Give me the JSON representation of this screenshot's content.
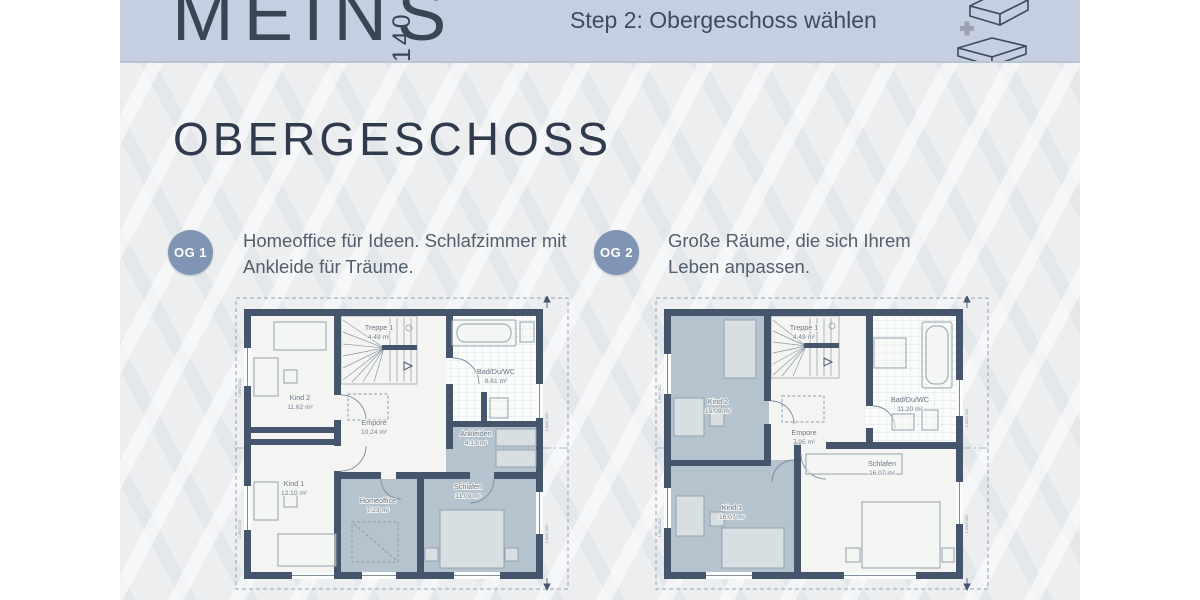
{
  "header": {
    "brand": "MEINS",
    "brand_number": "140",
    "step": "Step 2: Obergeschoss wählen",
    "icon": "add-upper-floor-icon"
  },
  "title": "OBERGESCHOSS",
  "colors": {
    "header_band": "#c5cfe1",
    "badge": "#8095b3",
    "wall": "#45566c",
    "room_shaded": "#b5c3ce",
    "heading_text": "#2f3b4c"
  },
  "options": [
    {
      "badge": "OG 1",
      "description": "Homeoffice für Ideen. Schlafzimmer mit Ankleide für Träume.",
      "rooms": {
        "treppe": {
          "name": "Treppe 1",
          "area": "4.49 m²"
        },
        "kind2": {
          "name": "Kind 2",
          "area": "11.62 m²"
        },
        "bad": {
          "name": "Bad/Du/WC",
          "area": "8.61 m²"
        },
        "empore": {
          "name": "Empore",
          "area": "10.24 m²"
        },
        "ankleiden": {
          "name": "Ankleiden",
          "area": "4.13 m²"
        },
        "kind1": {
          "name": "Kind 1",
          "area": "12.10 m²"
        },
        "homeoffice": {
          "name": "Homeoffice",
          "area": "7.23 m²"
        },
        "schlafen": {
          "name": "Schlafen",
          "area": "11.09 m²"
        }
      },
      "dims": {
        "left_upper": "1.99/2.192",
        "left_lower": "1.99/2.192",
        "right_upper": "1.00/2.092",
        "right_lower": "1.00/2.092"
      }
    },
    {
      "badge": "OG 2",
      "description": "Große Räume, die sich Ihrem Leben anpassen.",
      "rooms": {
        "treppe": {
          "name": "Treppe 1",
          "area": "4.49 m²"
        },
        "kind2": {
          "name": "Kind 2",
          "area": "15.09 m²"
        },
        "bad": {
          "name": "Bad/Du/WC",
          "area": "11.20 m²"
        },
        "empore": {
          "name": "Empore",
          "area": "7.95 m²"
        },
        "kind1": {
          "name": "Kind 1",
          "area": "16.07 m²"
        },
        "schlafen": {
          "name": "Schlafen",
          "area": "16.07 m²"
        }
      },
      "dims": {
        "left_upper": "1.99/2.092",
        "left_lower": "1.99/2.092",
        "right_upper": "1.00/2.092",
        "right_lower": "1.00/2.092"
      }
    }
  ]
}
